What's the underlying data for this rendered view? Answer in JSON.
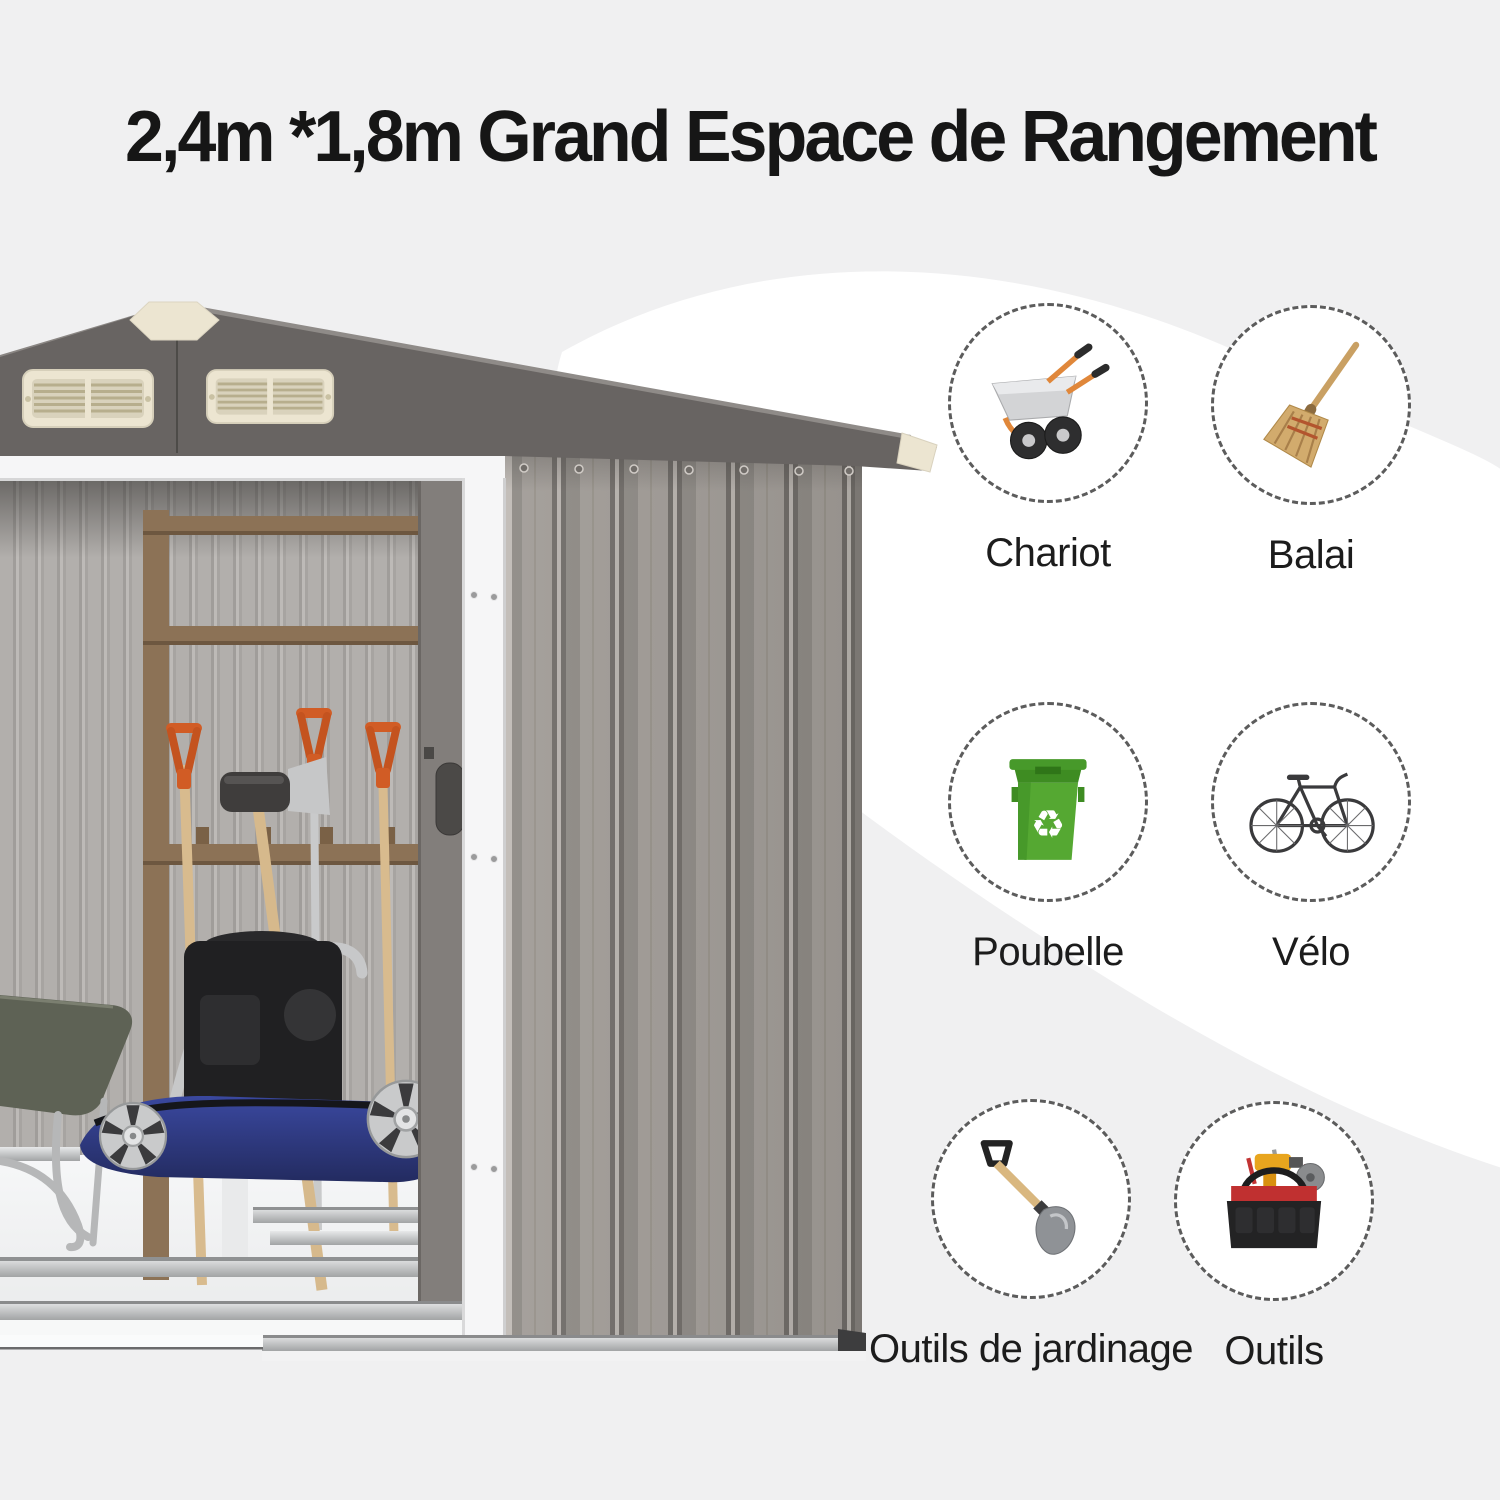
{
  "title": {
    "text": "2,4m *1,8m Grand Espace de Rangement"
  },
  "theme": {
    "bg": "#f0f0f1",
    "blob": "#ffffff",
    "title_color": "#161616",
    "label_color": "#1c1c1c",
    "circle_border": "#5c5c5c",
    "roof_gray": "#686462",
    "wall_gray": "#9a958f",
    "interior_gray": "#b2afac",
    "trim_white": "#f6f6f7",
    "cream": "#ece5d1",
    "accent_orange": "#d15c25",
    "wood_brown": "#8c7256",
    "mower_blue": "#303e93",
    "olive_green": "#5e6255",
    "bin_green": "#55a832",
    "metal_silver": "#c6c7c8"
  },
  "storage_items": [
    {
      "id": "chariot",
      "label": "Chariot",
      "icon": "wheelbarrow-icon"
    },
    {
      "id": "balai",
      "label": "Balai",
      "icon": "broom-icon"
    },
    {
      "id": "poubelle",
      "label": "Poubelle",
      "icon": "trash-bin-icon",
      "recycle_glyph": "♻"
    },
    {
      "id": "velo",
      "label": "Vélo",
      "icon": "bicycle-icon"
    },
    {
      "id": "outils-jardinage",
      "label": "Outils de jardinage",
      "icon": "garden-tools-icon"
    },
    {
      "id": "outils",
      "label": "Outils",
      "icon": "toolbox-icon"
    }
  ]
}
